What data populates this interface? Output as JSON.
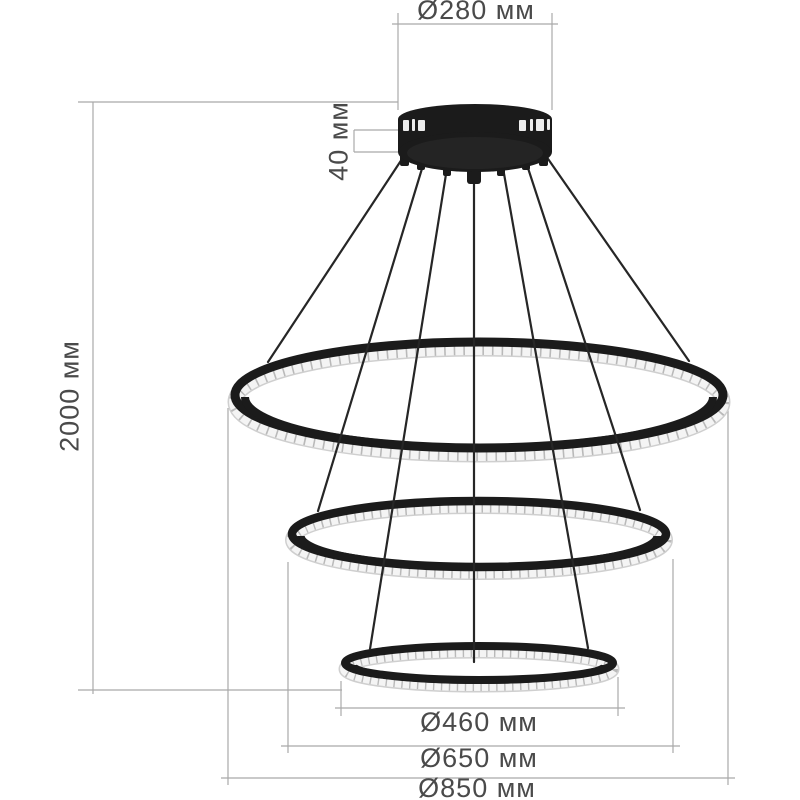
{
  "unit": "мм",
  "labels": {
    "canopy_diameter": "Ø280 мм",
    "canopy_height": "40 мм",
    "suspension_height": "2000 мм",
    "small_ring_diameter": "Ø460 мм",
    "middle_ring_diameter": "Ø650 мм",
    "large_ring_diameter": "Ø850 мм"
  },
  "values_mm": {
    "canopy_diameter": 280,
    "canopy_height": 40,
    "suspension_height": 2000,
    "ring_diameters": [
      460,
      650,
      850
    ]
  },
  "colors": {
    "background": "#ffffff",
    "dimension_lines": "#a9a9a9",
    "label_text": "#4a4a4a",
    "fixture_black": "#1b1b1b",
    "crystal_band": "#f4f4f4",
    "crystal_facets": "#b9b9b9",
    "wire": "#262626"
  }
}
